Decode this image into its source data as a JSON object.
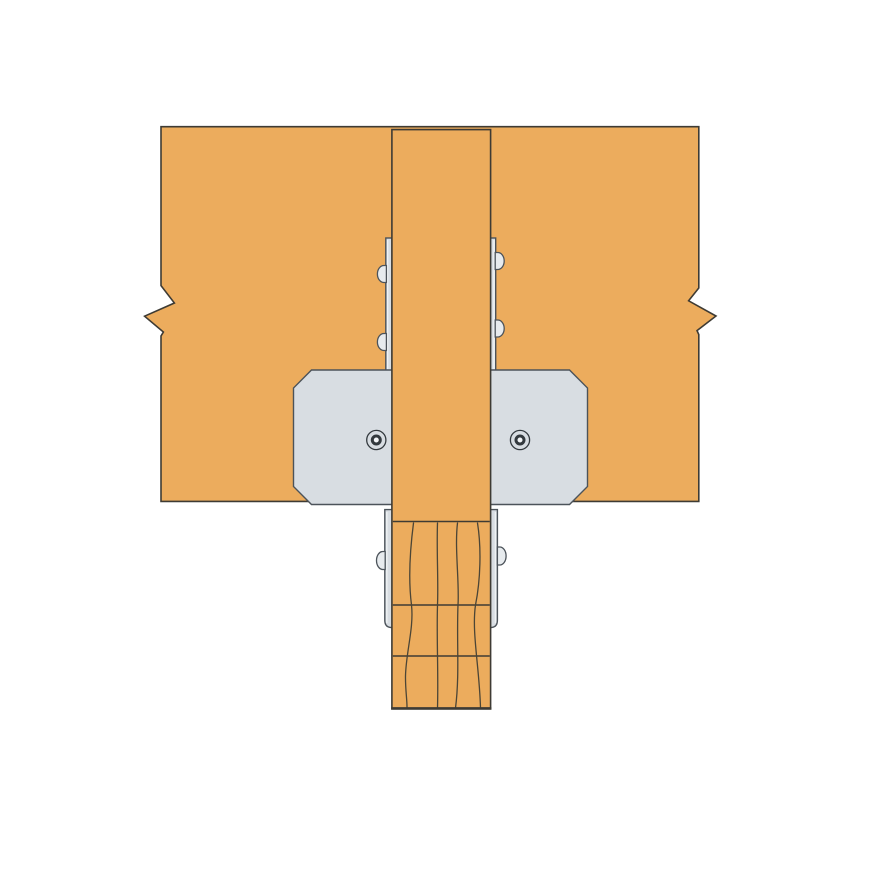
{
  "canvas": {
    "width": 880,
    "height": 880,
    "background": "#ffffff"
  },
  "colors": {
    "bg": "#ffffff",
    "wood": "#ECAC5D",
    "wood-stroke": "#3E3B34",
    "steel": "#D8DDE2",
    "steel-stroke": "#4C535A",
    "steel-highlight": "#EFF2F4",
    "bolt": "#E7EBEE",
    "grain": "#4B4536",
    "ring-stroke": "#33393E"
  },
  "illustration": {
    "subject": "wood post-to-beam steel connector, line-art product illustration",
    "text_labels": [],
    "parts": [
      {
        "name": "horizontal-beam",
        "material": "wood",
        "break_marks": 2
      },
      {
        "name": "through-post",
        "material": "wood"
      },
      {
        "name": "connector-face-plate",
        "material": "steel",
        "corner_style": "chamfered",
        "ring_fasteners": 2
      },
      {
        "name": "upper-side-straps",
        "material": "steel",
        "bolt_heads": 4
      },
      {
        "name": "lower-side-plates",
        "material": "steel",
        "bolt_heads": 2,
        "corner_style": "rounded-bottom"
      },
      {
        "name": "laminated-column",
        "material": "wood",
        "lamination_joints": 3,
        "grain_lines": 4
      }
    ]
  }
}
